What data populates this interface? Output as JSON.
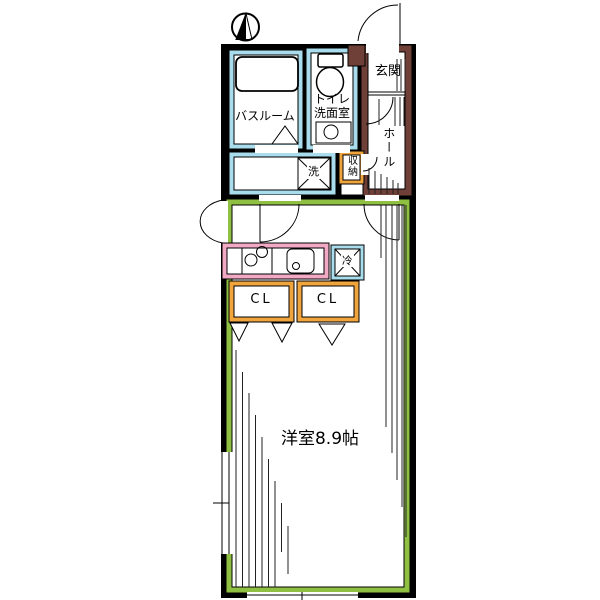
{
  "compass": {
    "meaning": "north-up"
  },
  "rooms": {
    "bathroom": "バスルーム",
    "toilet_line1": "トイレ",
    "toilet_line2": "洗面室",
    "entrance": "玄関",
    "hall": "ホール",
    "storage": "収納",
    "laundry": "洗",
    "fridge": "冷",
    "closet_left": "CL",
    "closet_right": "CL",
    "main_room": "洋室8.9帖"
  },
  "colors": {
    "wall": "#000000",
    "wet_area": "#A9DCEC",
    "entrance_hall": "#6F4038",
    "storage": "#F0A43C",
    "kitchen": "#F2A9C4",
    "main_room": "#8FC041",
    "background": "#FFFFFF",
    "line": "#1a1a1a"
  }
}
